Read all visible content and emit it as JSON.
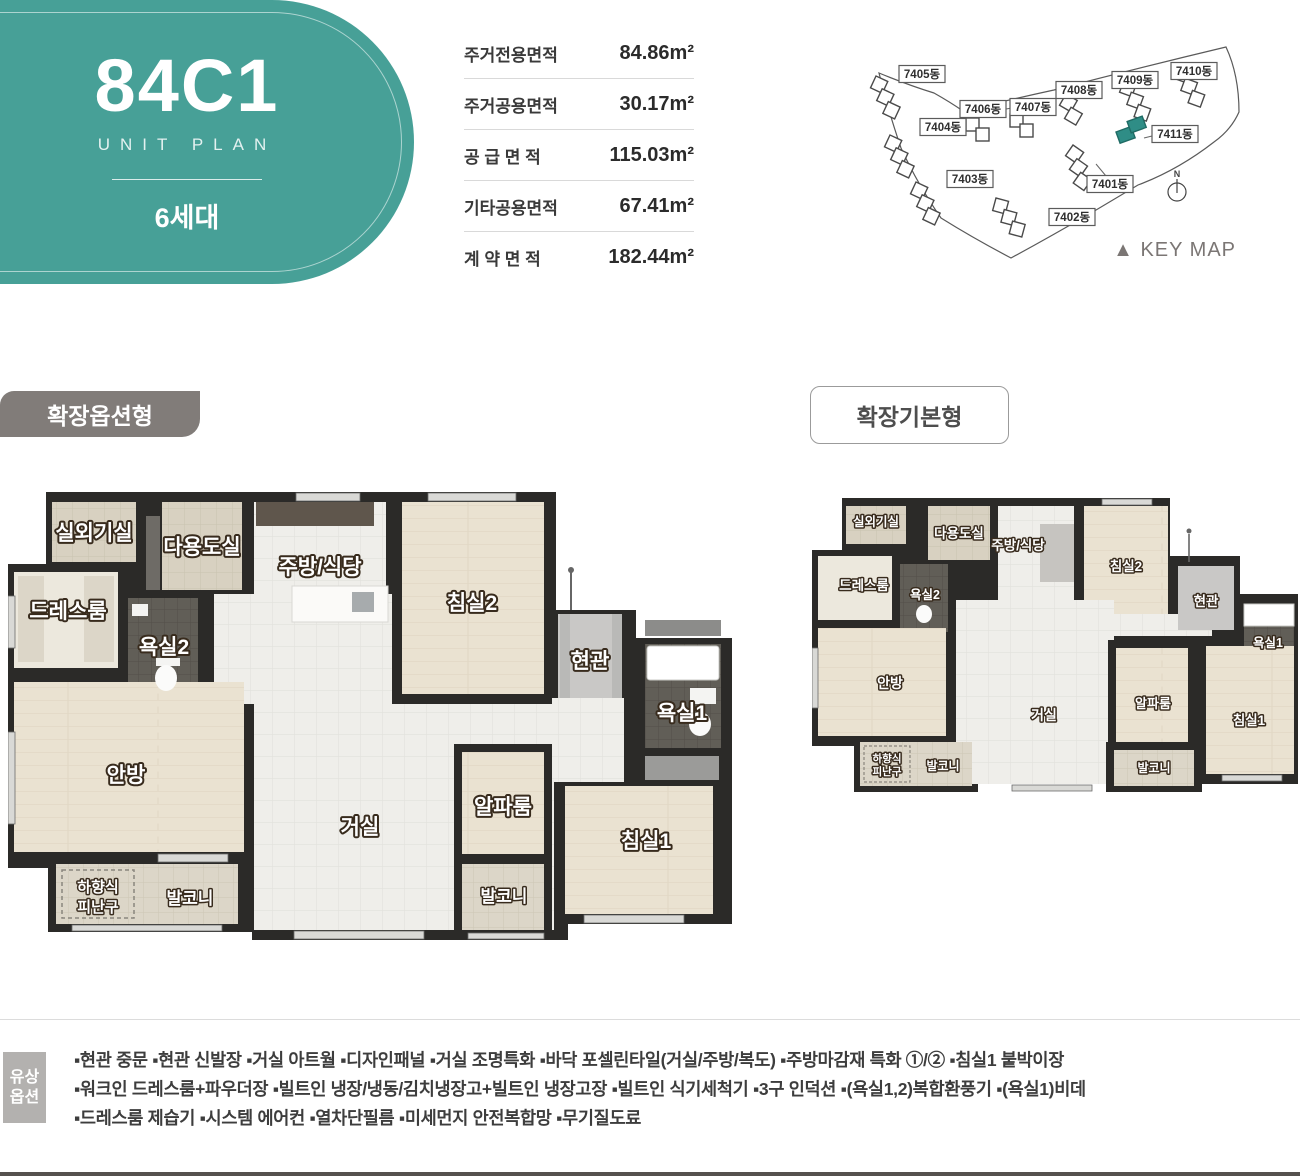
{
  "badge": {
    "unit_name": "84C1",
    "subtitle": "UNIT PLAN",
    "household": "6세대"
  },
  "area_table": {
    "rows": [
      {
        "label": "주거전용면적",
        "value": "84.86m²"
      },
      {
        "label": "주거공용면적",
        "value": "30.17m²"
      },
      {
        "label": "공 급 면 적",
        "value": "115.03m²"
      },
      {
        "label": "기타공용면적",
        "value": "67.41m²"
      },
      {
        "label": "계 약 면 적",
        "value": "182.44m²"
      }
    ]
  },
  "keymap": {
    "labels": {
      "b7401": "7401동",
      "b7402": "7402동",
      "b7403": "7403동",
      "b7404": "7404동",
      "b7405": "7405동",
      "b7406": "7406동",
      "b7407": "7407동",
      "b7408": "7408동",
      "b7409": "7409동",
      "b7410": "7410동",
      "b7411": "7411동"
    },
    "highlight_building": "7411동",
    "north": "N",
    "caption": "▲ KEY MAP"
  },
  "sections": {
    "expand_option": "확장옵션형",
    "expand_basic": "확장기본형"
  },
  "rooms": {
    "outdoor_unit": "실외기실",
    "utility": "다용도실",
    "kitchen": "주방/식당",
    "bedroom2": "침실2",
    "dressroom": "드레스룸",
    "bath2": "욕실2",
    "entrance": "현관",
    "bath1": "욕실1",
    "master": "안방",
    "living": "거실",
    "alpha": "알파룸",
    "bedroom1": "침실1",
    "escape_l1": "하향식",
    "escape_l2": "피난구",
    "balcony": "발코니"
  },
  "options": {
    "tag_l1": "유상",
    "tag_l2": "옵션",
    "lines": [
      "▪현관 중문   ▪현관 신발장   ▪거실 아트월   ▪디자인패널   ▪거실 조명특화   ▪바닥 포셀린타일(거실/주방/복도)   ▪주방마감재 특화 ①/②   ▪침실1 붙박이장",
      "▪워크인 드레스룸+파우더장   ▪빌트인 냉장/냉동/김치냉장고+빌트인 냉장고장   ▪빌트인 식기세척기   ▪3구 인덕션   ▪(욕실1,2)복합환풍기   ▪(욕실1)비데",
      "▪드레스룸 제습기   ▪시스템 에어컨   ▪열차단필름   ▪미세먼지 안전복합망   ▪무기질도료"
    ]
  },
  "colors": {
    "teal": "#47a097",
    "label_gray": "#817c79",
    "highlight_building": "#2f8d86"
  }
}
